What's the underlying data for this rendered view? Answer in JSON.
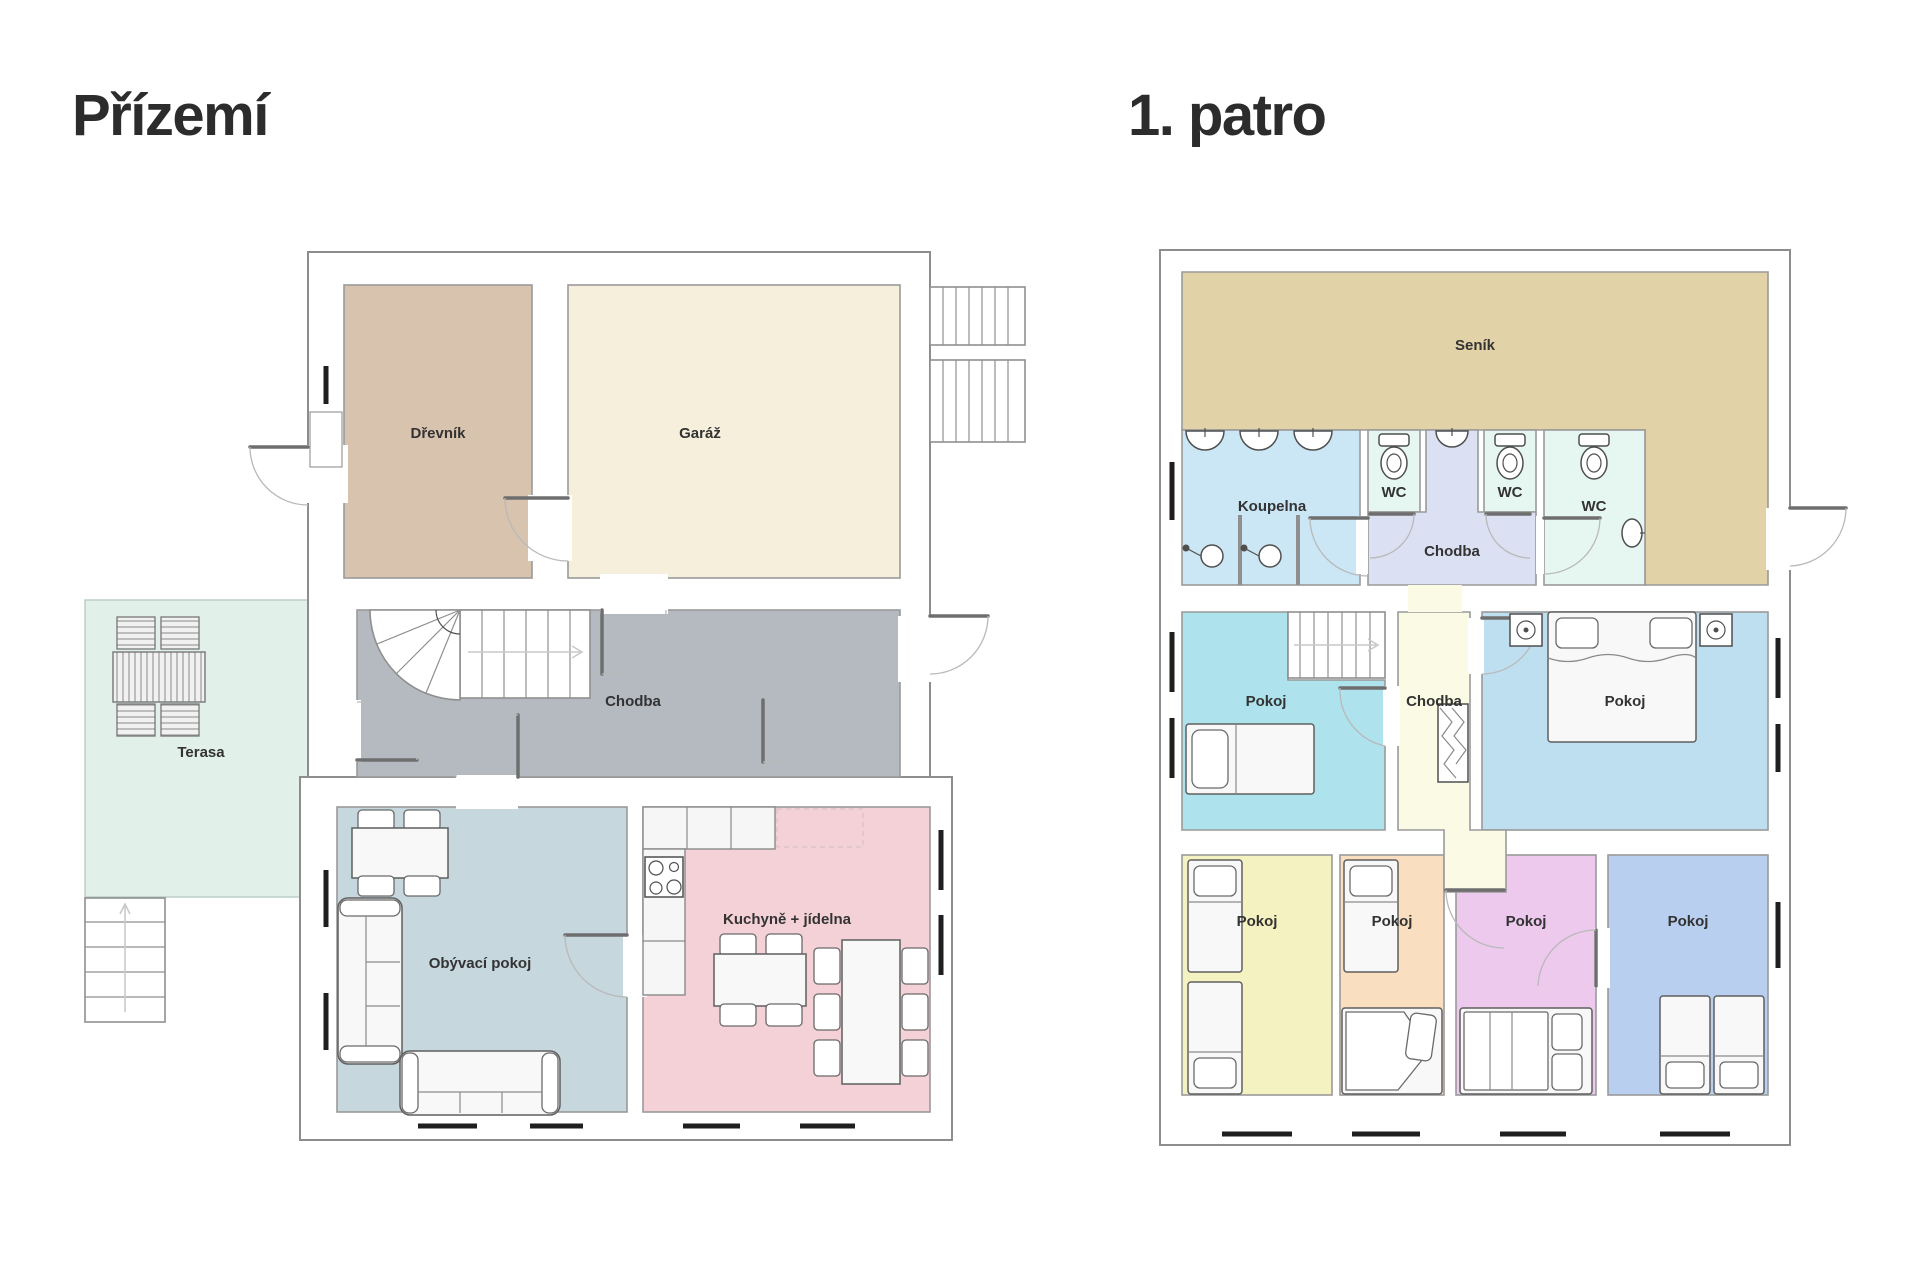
{
  "titles": {
    "ground": "Přízemí",
    "first": "1. patro"
  },
  "ground_floor": {
    "rooms": {
      "drevnik": "Dřevník",
      "garaz": "Garáž",
      "chodba": "Chodba",
      "terasa": "Terasa",
      "obyvaci_pokoj": "Obývací pokoj",
      "kuchyne": "Kuchyně + jídelna"
    }
  },
  "first_floor": {
    "rooms": {
      "senik": "Seník",
      "koupelna": "Koupelna",
      "wc_1": "WC",
      "wc_2": "WC",
      "wc_3": "WC",
      "chodba_horni": "Chodba",
      "pokoj_nw": "Pokoj",
      "chodba_stred": "Chodba",
      "pokoj_ne": "Pokoj",
      "pokoj_sw": "Pokoj",
      "pokoj_s1": "Pokoj",
      "pokoj_s2": "Pokoj",
      "pokoj_se": "Pokoj"
    }
  },
  "colors": {
    "drevnik": "#d8c3ae",
    "garaz": "#f5efdc",
    "chodba_prizemi": "#b4bac0",
    "terasa": "#e1f0e9",
    "obyvaci": "#c6d7dd",
    "kuchyne": "#f4d1d7",
    "senik": "#e2d2a7",
    "koupelna": "#cbe7f5",
    "wc": "#e6f6f1",
    "chodba_horni": "#dbe1f3",
    "pokoj_nw": "#aee2ed",
    "chodba_stred": "#fbfae4",
    "pokoj_ne": "#bedff0",
    "pokoj_sw": "#f5f2c1",
    "pokoj_s1": "#f9dfc0",
    "pokoj_s2": "#edc9ed",
    "pokoj_se": "#b8cfef"
  }
}
